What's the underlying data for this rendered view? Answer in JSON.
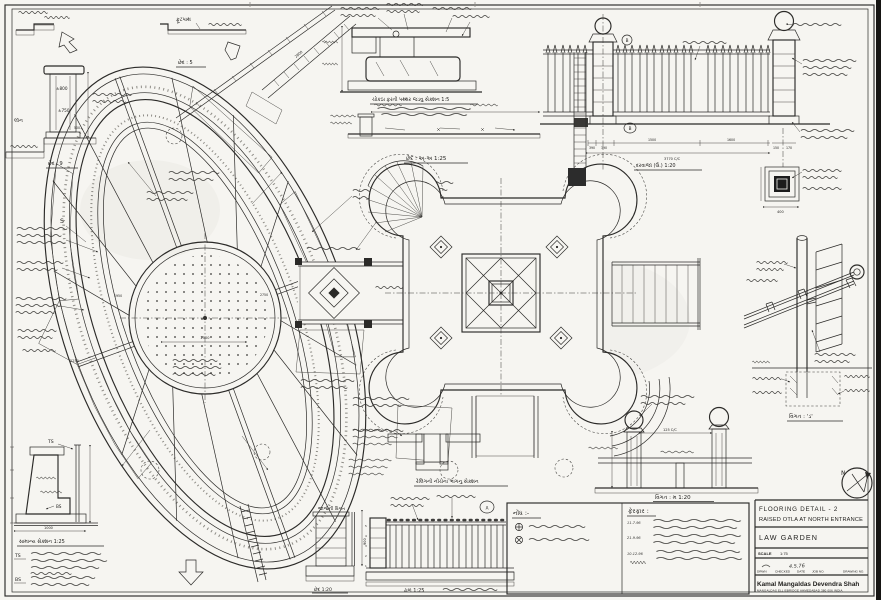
{
  "title_block": {
    "title_line1": "FLOORING DETAIL - 2",
    "title_line2": "RAISED OTLA AT NORTH ENTRANCE",
    "project": "LAW GARDEN",
    "scale_label": "SCALE",
    "scale_value": "1:75",
    "f_drwn": "DRWN",
    "f_checked": "CHECKED",
    "f_date": "DATE",
    "f_job": "JOB NO.",
    "f_drawing": "DRAWING NO.",
    "date_value": "4.5.76",
    "architects": "Kamal Mangaldas  Devendra Shah",
    "address": "MANGALDAS    ELLISBRIDGE    AHMEDABAD    380 006    INDIA"
  },
  "captions": {
    "footpath": "ફૂટપાથ",
    "section5": "છેદ : 5",
    "section9": "છેદ : 9",
    "lawn": "લૉન",
    "masonry": "ચોકઠા ફરતી પથ્થર જડવુ સેક્શન  1:5",
    "section_aa": "છેદ : અ-અ  1:25",
    "gate": "દરવાજા (ઉ.)  1:20",
    "grill": "જાળીની વિગત",
    "railing_under": "રેલિંગની નીચેના ભાગનુ સેક્શન",
    "slope": "ઢાળ  1:25",
    "section_small": "છેદ  1:20",
    "general_section": "સામાન્ય સેક્શન  1:25",
    "detail_da": "વિગત : 'ડ'",
    "detail_ma": "વિગત : મ  1:20",
    "notes_header": "નોંધ :-",
    "revisions_header": "ફેરફાર :"
  },
  "revisions": [
    "11-7-96",
    "21-9-96",
    "10-12-96"
  ],
  "dims": {
    "p800": "±800",
    "p750": "±750",
    "p500": "500",
    "w2800": "2800",
    "c2500": "2500",
    "r1950": "1950",
    "r2250": "2250",
    "r2750": "2750",
    "f390a": "390",
    "f390b": "390",
    "f1500": "1500",
    "f1600": "1600",
    "fcc": "3770 C/C",
    "p150": "150",
    "p170": "170",
    "ft400": "400",
    "bcc": "125 C/C",
    "w1000": "1000",
    "r900": "900"
  },
  "callouts": {
    "ts": "TS",
    "ts_note": "TS",
    "bs": "BS",
    "bs_note": "BS",
    "s": "S",
    "b1": "B",
    "b2": "B",
    "a": "A",
    "n": "N"
  },
  "rail_courses": [
    "5",
    "4",
    "3",
    "2",
    "1"
  ],
  "colors": {
    "ink": "#2b2a28",
    "paper": "#f6f5f1"
  }
}
